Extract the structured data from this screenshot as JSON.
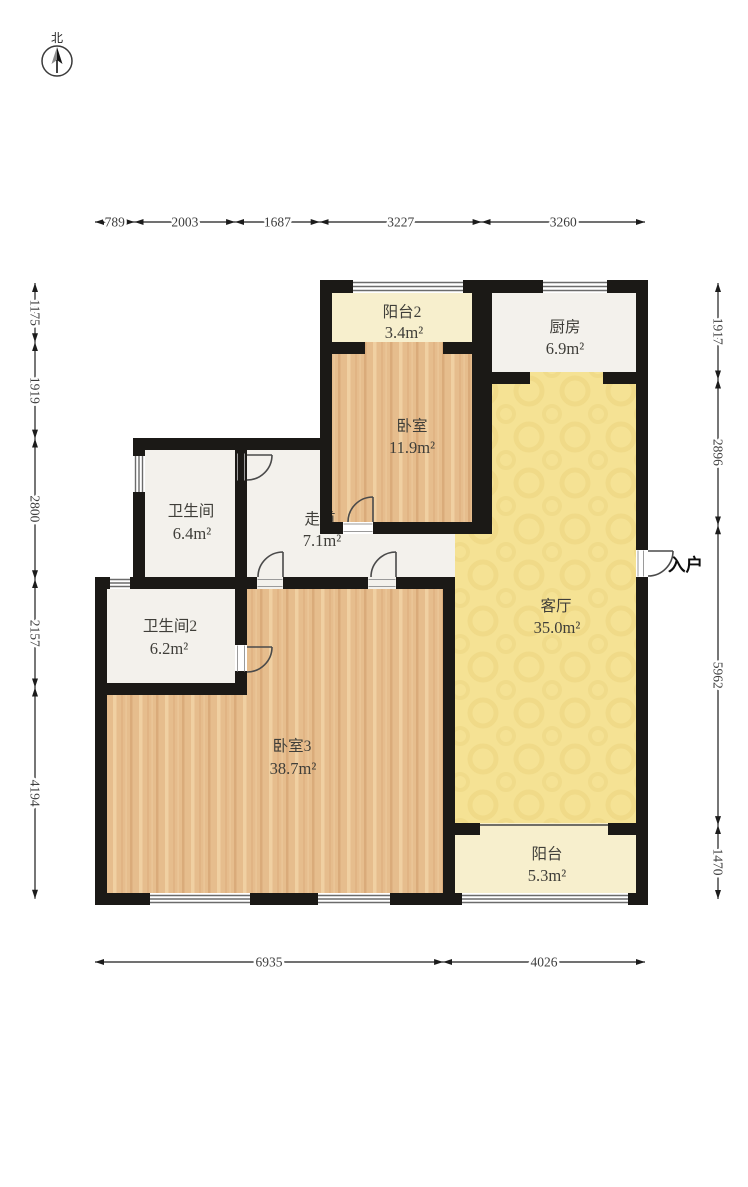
{
  "compass": {
    "north": "北"
  },
  "entry": {
    "label": "入户"
  },
  "rooms": {
    "balcony2": {
      "name": "阳台2",
      "area": "3.4m²"
    },
    "kitchen": {
      "name": "厨房",
      "area": "6.9m²"
    },
    "bedroom": {
      "name": "卧室",
      "area": "11.9m²"
    },
    "bathroom": {
      "name": "卫生间",
      "area": "6.4m²"
    },
    "corridor": {
      "name": "走道",
      "area": "7.1m²"
    },
    "bathroom2": {
      "name": "卫生间2",
      "area": "6.2m²"
    },
    "living": {
      "name": "客厅",
      "area": "35.0m²"
    },
    "bedroom3": {
      "name": "卧室3",
      "area": "38.7m²"
    },
    "balcony": {
      "name": "阳台",
      "area": "5.3m²"
    }
  },
  "dimensions": {
    "top": [
      "789",
      "2003",
      "1687",
      "3227",
      "3260"
    ],
    "left": [
      "1175",
      "1919",
      "2800",
      "2157",
      "4194"
    ],
    "right": [
      "1917",
      "2896",
      "5962",
      "1470"
    ],
    "bottom": [
      "6935",
      "4026"
    ]
  },
  "colors": {
    "wall": "#1b1916",
    "wood": "#e6bd8d",
    "wood_dark": "#d5a170",
    "wood_light": "#f2d4a8",
    "cream": "#f7efcd",
    "plaster": "#f3f1ec",
    "living": "#f5e294",
    "living_dark": "#e9d07a",
    "dim": "#3d3d3d",
    "label": "#3f3e39",
    "door": "#4a4a4a",
    "window": "#6b6b6b"
  }
}
